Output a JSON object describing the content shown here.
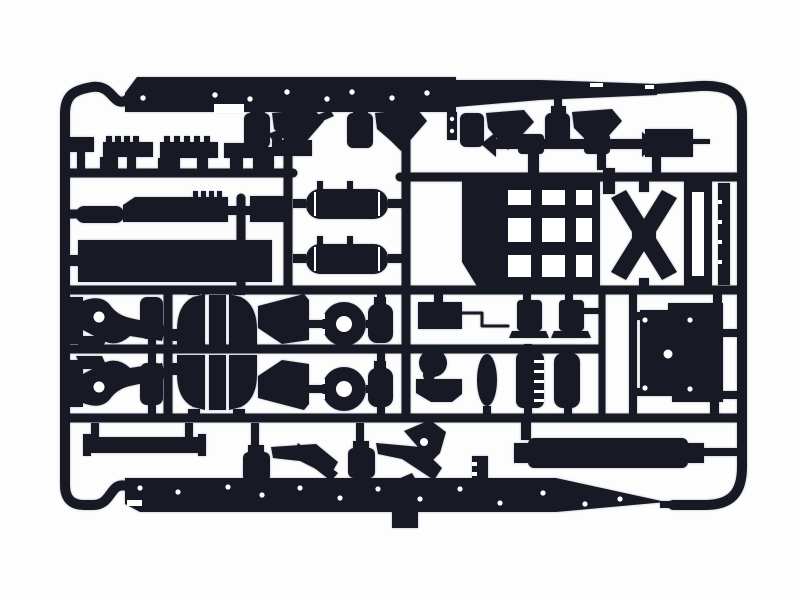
{
  "scene": {
    "title": "Black plastic model kit sprue with truck chassis parts on white background",
    "description": "Photograph of a dark injection-moulded sprue (parts tree): two long chassis rails at top and bottom, runner grid, air tanks, axle housings, wheel hubs, spring hangers, crossmembers, muffler cylinder and a flat mud-flap plate.",
    "colors": {
      "background": "#fdfdfe",
      "plastic": "#171a24",
      "highlight": "#ffffff"
    },
    "parts": [
      "sprue-frame",
      "chassis-rail-top",
      "chassis-rail-bottom",
      "brake-chamber-assemblies",
      "small-brackets-row",
      "battery-box-upper",
      "battery-box-lower",
      "air-tank-1",
      "air-tank-2",
      "spring-hanger-pair",
      "axle-housing-fins",
      "wheel-hub-pair",
      "air-reservoirs",
      "front-axle",
      "crossmember-grid",
      "x-crossmember",
      "ladder-rails",
      "ribbed-strip",
      "mudflap-plate",
      "bumper-bar",
      "muffler-cylinder",
      "hanging-box"
    ]
  }
}
